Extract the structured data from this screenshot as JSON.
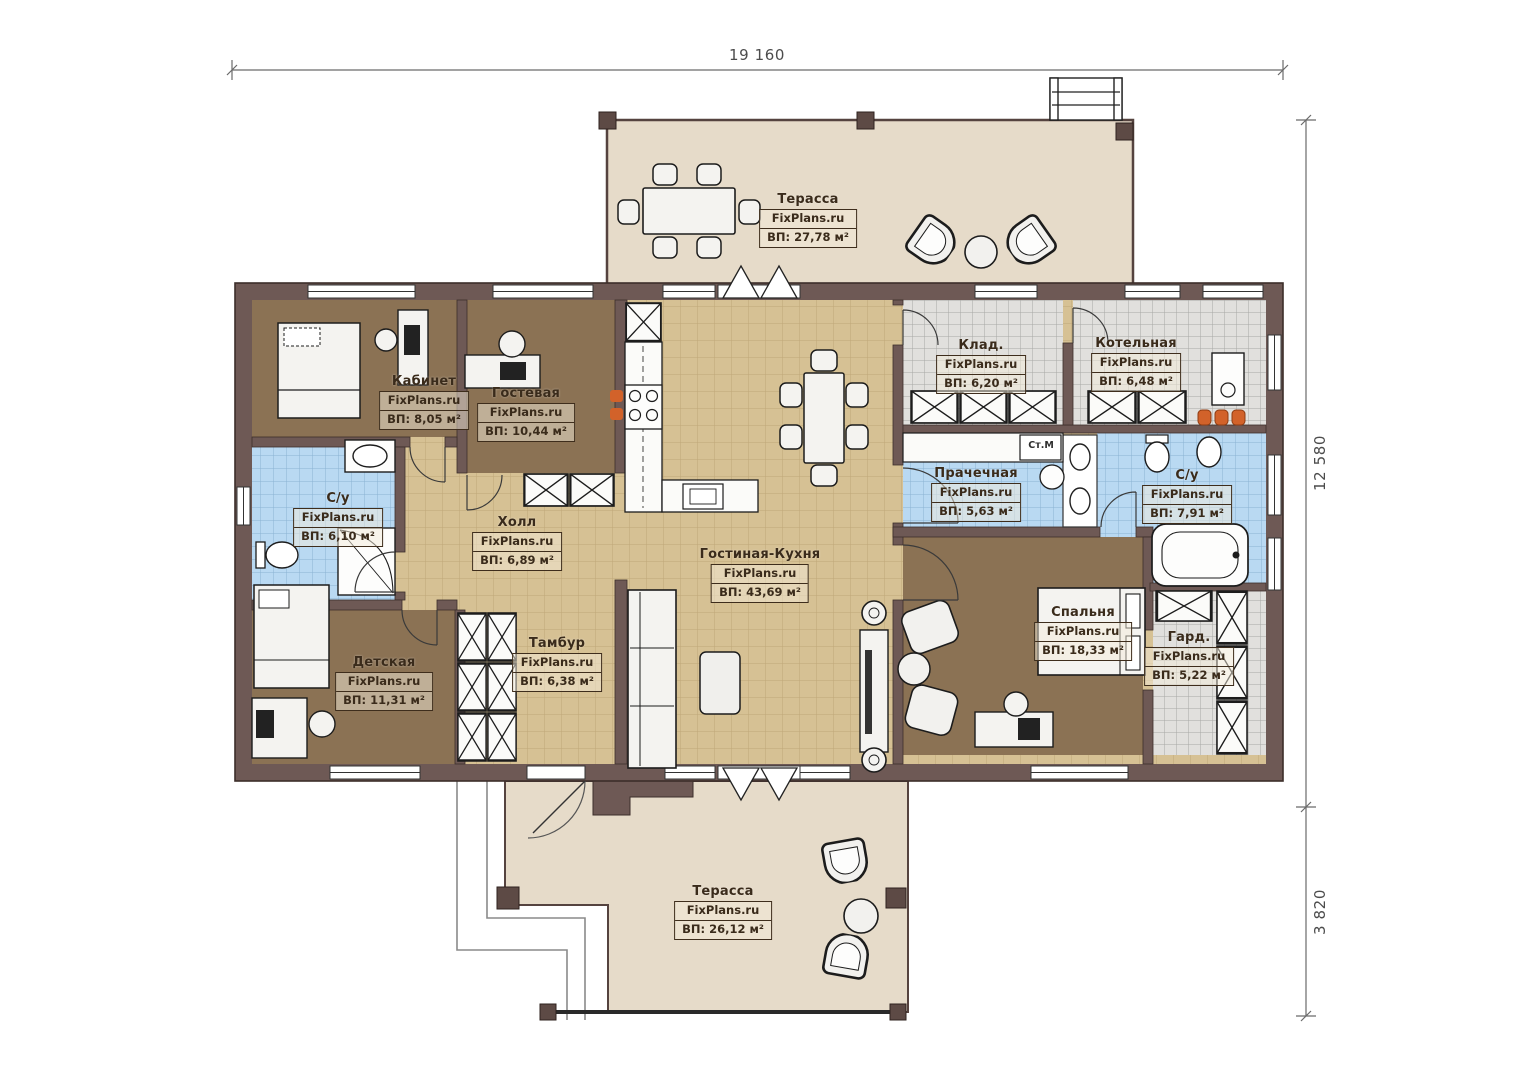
{
  "plan": {
    "brand": "FixPlans.ru",
    "dimensions": {
      "top_width": "19 160",
      "right_height_main": "12 580",
      "right_height_terrace": "3 820"
    },
    "appliance_label": "Ст.М",
    "colors": {
      "wall": "#6e5955",
      "wall_outline": "#3c2e2a",
      "terrace_floor": "#e6dbc9",
      "tile_floor": "#d6c194",
      "room_floor": "#8b7254",
      "wet_floor": "#b9d9f2",
      "utility_floor": "#e1e0dd",
      "accent_orange": "#d2622a"
    }
  },
  "rooms": [
    {
      "id": "terrace-top",
      "name": "Терасса",
      "area": "ВП: 27,78 м²"
    },
    {
      "id": "kabinet",
      "name": "Кабинет",
      "area": "ВП: 8,05 м²"
    },
    {
      "id": "gostevaya",
      "name": "Гостевая",
      "area": "ВП: 10,44 м²"
    },
    {
      "id": "su-left",
      "name": "С/у",
      "area": "ВП: 6,10 м²"
    },
    {
      "id": "kholl",
      "name": "Холл",
      "area": "ВП: 6,89 м²"
    },
    {
      "id": "living-kitchen",
      "name": "Гостиная-Кухня",
      "area": "ВП: 43,69 м²"
    },
    {
      "id": "klad",
      "name": "Клад.",
      "area": "ВП: 6,20 м²"
    },
    {
      "id": "kotelnaya",
      "name": "Котельная",
      "area": "ВП: 6,48 м²"
    },
    {
      "id": "prachechnaya",
      "name": "Прачечная",
      "area": "ВП: 5,63 м²"
    },
    {
      "id": "su-right",
      "name": "С/у",
      "area": "ВП: 7,91 м²"
    },
    {
      "id": "detskaya",
      "name": "Детская",
      "area": "ВП: 11,31 м²"
    },
    {
      "id": "tambur",
      "name": "Тамбур",
      "area": "ВП: 6,38 м²"
    },
    {
      "id": "spalnya",
      "name": "Спальня",
      "area": "ВП: 18,33 м²"
    },
    {
      "id": "gard",
      "name": "Гард.",
      "area": "ВП: 5,22 м²"
    },
    {
      "id": "terrace-bottom",
      "name": "Терасса",
      "area": "ВП: 26,12 м²"
    }
  ]
}
